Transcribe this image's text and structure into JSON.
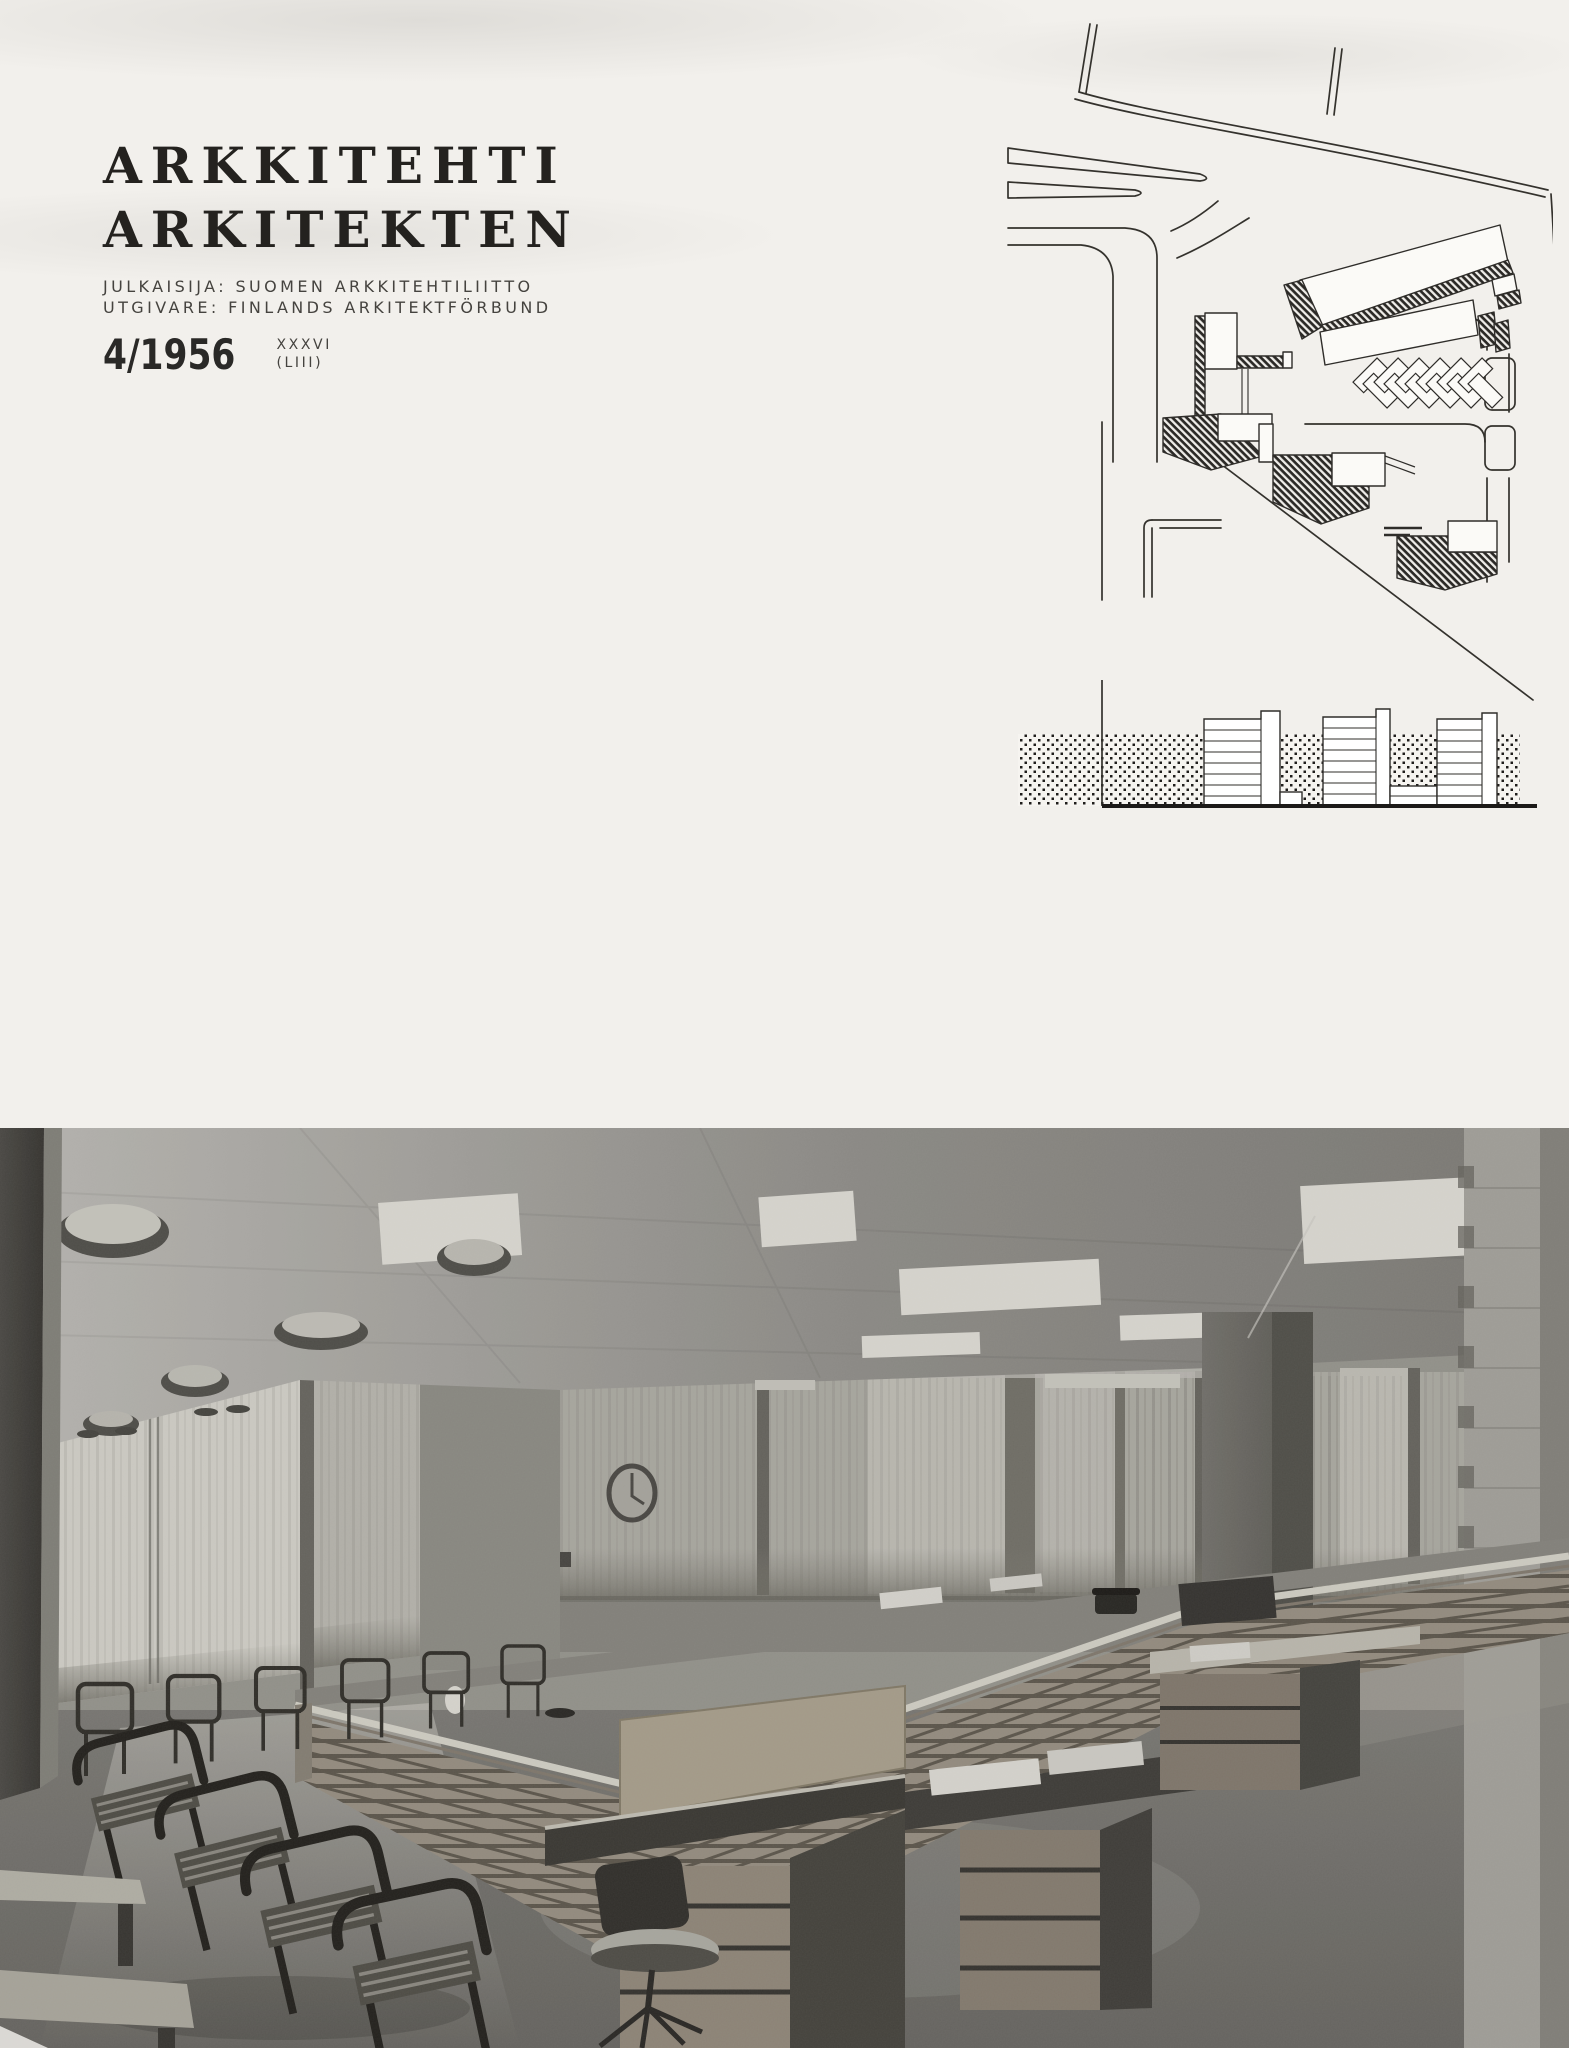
{
  "page": {
    "background": "#f2f0ec",
    "ink": "#24221f"
  },
  "masthead": {
    "title_line1": "ARKKITEHTI",
    "title_line2": "ARKITEKTEN",
    "publisher_line1": "JULKAISIJA: SUOMEN ARKKITEHTILIITTO",
    "publisher_line2": "UTGIVARE: FINLANDS ARKITEKTFÖRBUND",
    "issue": {
      "number": "4/1956",
      "volume": "XXXVI",
      "series": "(LIII)"
    }
  },
  "site_plan": {
    "ink": "#34322d",
    "description": "Line-drawn site plan: curving roads, hatched building slabs, herringbone row of houses, street elevation of three tower slabs on dotted ground band"
  },
  "photo": {
    "description": "Black-and-white photograph of a banking-hall interior: slatted wood counter, rows of chairs, curtained windows, saucer lamps, ceiling light panels, desks and swivel chair",
    "tone_light": "#dcdad2",
    "tone_dark": "#4a4843"
  }
}
